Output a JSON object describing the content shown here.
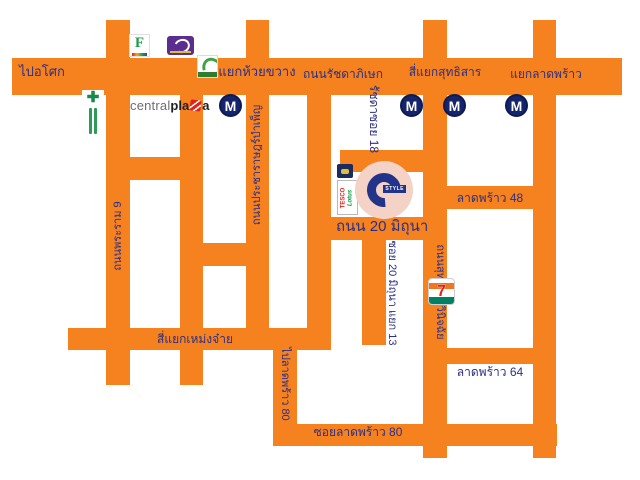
{
  "colors": {
    "road_orange": "#F5821F",
    "label_navy": "#2B2F84",
    "mrt_navy": "#15256b",
    "style_circle_pink": "#F4D2C6",
    "style_navy": "#23338A",
    "background": "#FFFFFF"
  },
  "labels": {
    "to_asok": "ไปอโศก",
    "huai_khwang_intersection": "สี่แยกห้วยขวาง",
    "ratchadaphisek_road": "ถนนรัชดาภิเษก",
    "sutthisan_intersection": "สี่แยกสุทธิสาร",
    "lat_phrao_junction": "แยกลาดพร้าว",
    "rama9_road": "ถนนพระราม 9",
    "pracharat_bamphen_road": "ถนนประชาราษฎร์บำเพ็ญ",
    "ratchada_soi_18": "รัชดาซอย 18",
    "road_20_mithuna": "ถนน 20 มิถุนา",
    "soi_20_mithuna_yaek_13": "ซอย 20 มิถุนา แยก 13",
    "sutthisan_winitchai_road": "ถนนสุทธิสารวินิจฉัย",
    "lat_phrao_48": "ลาดพร้าว 48",
    "lat_phrao_64": "ลาดพร้าว 64",
    "meng_jai_intersection": "สี่แยกเหม่งจ๋าย",
    "to_lat_phrao_80": "ไปลาดพร้าว 80",
    "soi_lat_phrao_80": "ซอยลาดพร้าว 80"
  },
  "icons": {
    "mrt_letter": "M",
    "fortune_letter": "F",
    "seven_eleven_digit": "7",
    "style_text": "STYLE",
    "tesco_text": "TESCO",
    "lotus_text": "Lotus"
  },
  "central_plaza": {
    "part1": "central",
    "part2": "pla",
    "part3": "a"
  }
}
